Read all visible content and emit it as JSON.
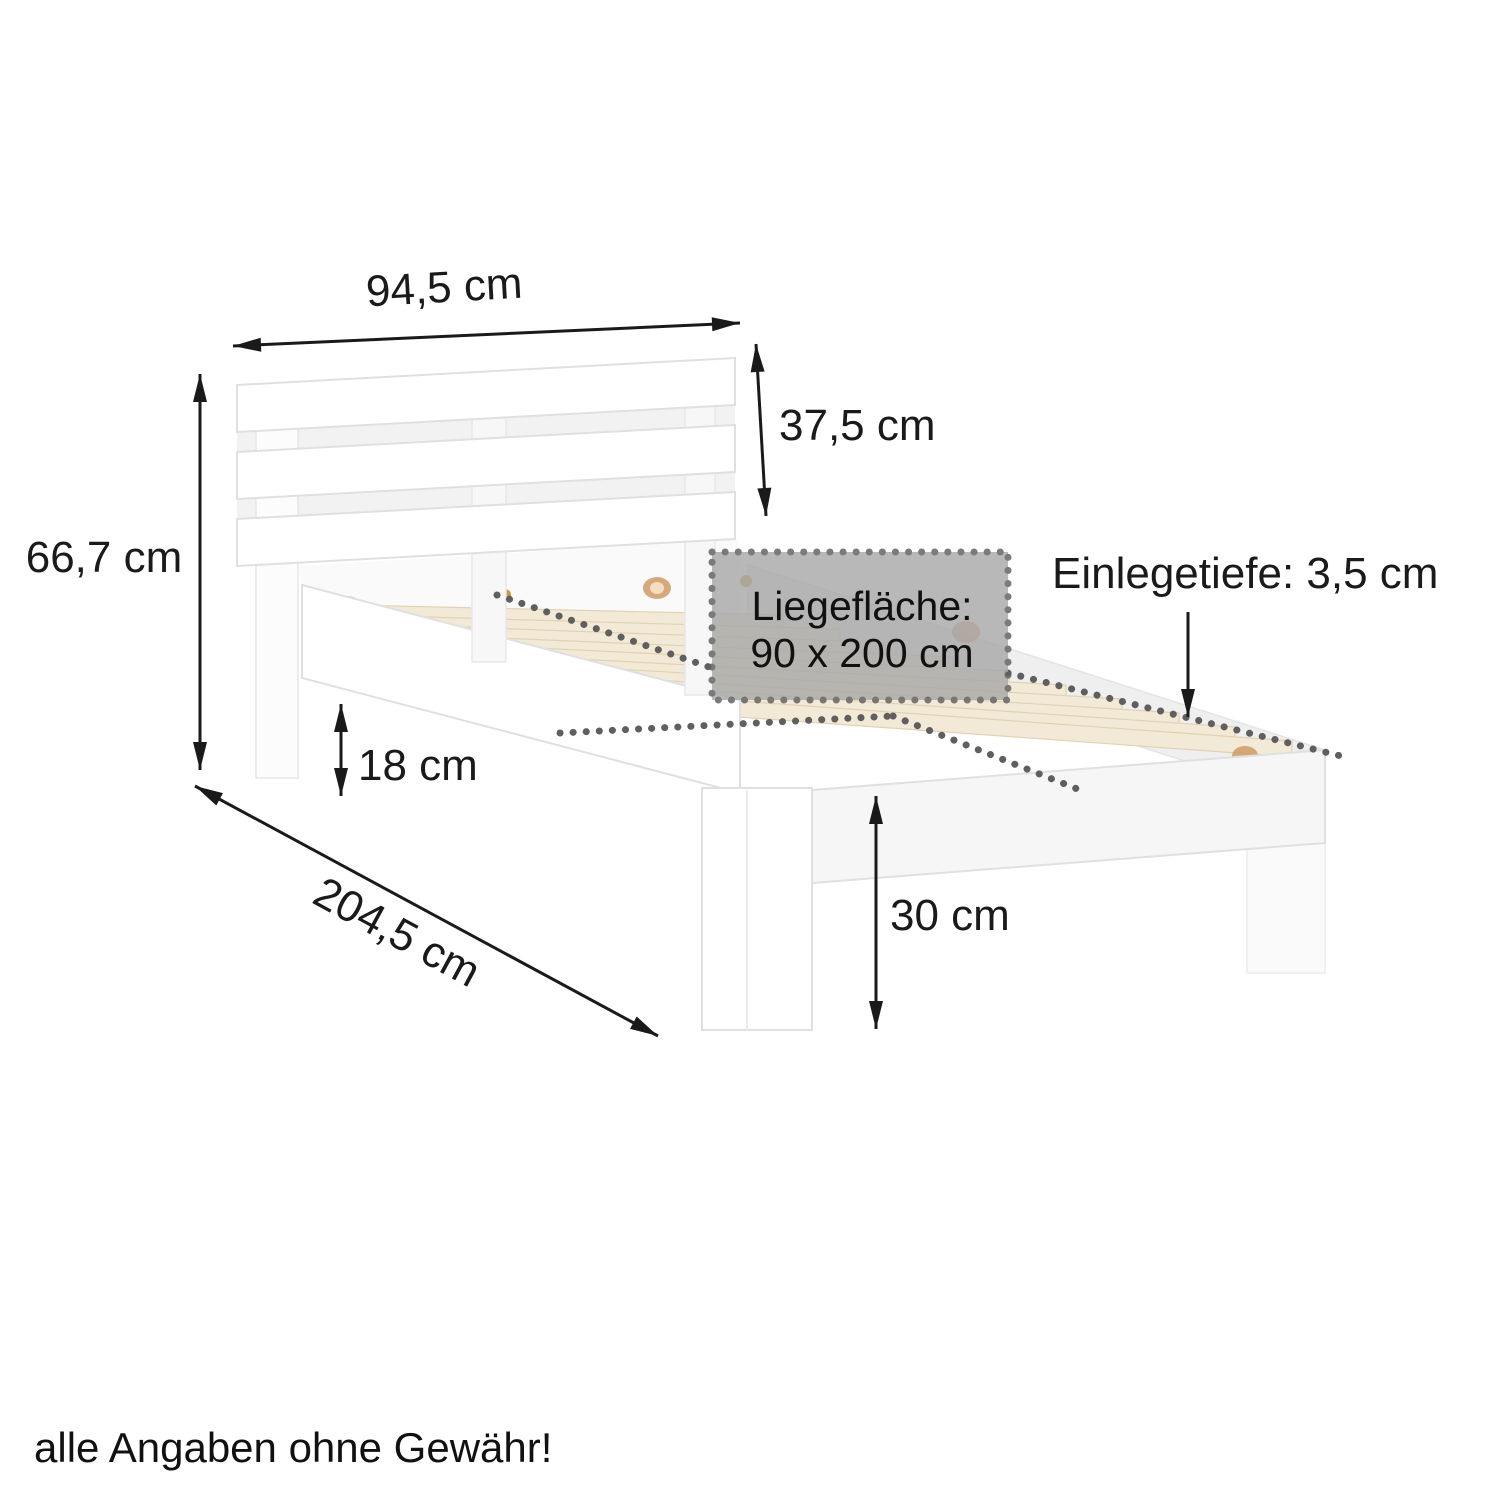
{
  "diagram": {
    "kind": "bed-frame-dimension-diagram",
    "subject": "white wooden single bed frame with slatted base and headboard, isometric product illustration",
    "bed": {
      "frame_color": "#ffffff",
      "edge_color": "#e0e0e0",
      "slat_color": "#f3e9d7",
      "slat_edge_color": "#e2d2b4",
      "visible_base_slats": 10,
      "headboard_slats": 3,
      "dowel_color": "#cf9a66",
      "screw_color": "#c89a3a"
    },
    "overlay": {
      "box_fill": "#a9a9a9",
      "box_opacity": 0.82,
      "dot_color": "#5f5f5f",
      "title": "Liegefläche:",
      "size": "90 x 200 cm"
    },
    "dimensions": [
      {
        "id": "headboard-width",
        "label": "94,5 cm"
      },
      {
        "id": "headboard-height",
        "label": "37,5 cm"
      },
      {
        "id": "total-height",
        "label": "66,7 cm"
      },
      {
        "id": "underbed-clearance",
        "label": "18 cm"
      },
      {
        "id": "frame-length",
        "label": "204,5 cm"
      },
      {
        "id": "foot-height",
        "label": "30 cm"
      },
      {
        "id": "insert-depth",
        "label": "Einlegetiefe: 3,5 cm"
      }
    ],
    "disclaimer": "alle Angaben ohne Gewähr!",
    "text_color": "#1a1a1a"
  }
}
